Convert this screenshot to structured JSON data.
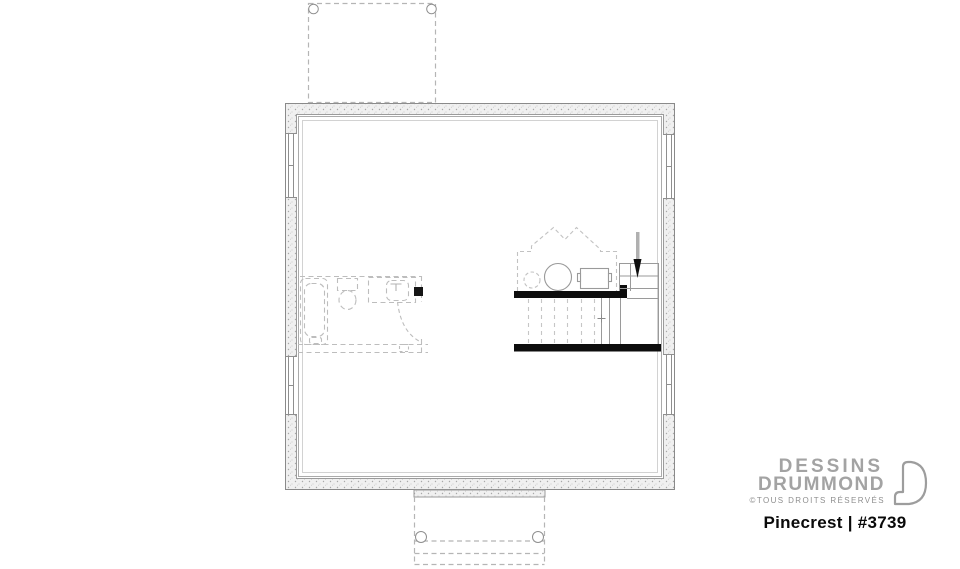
{
  "branding": {
    "name_line1": "DESSINS",
    "name_line2": "DRUMMOND",
    "rights": "©TOUS DROITS RÉSERVÉS",
    "logo_icon": "drummond-d-icon"
  },
  "plan": {
    "title": "Pinecrest | #3739",
    "name": "Pinecrest",
    "number": "#3739"
  },
  "drawing": {
    "type": "basement-floor-plan",
    "colors": {
      "wall_stipple_fill": "#f0f0f0",
      "wall_line": "#8a8a8a",
      "fixture_line": "#9a9a9a",
      "dashed_line": "#bdbdbd",
      "solid_black": "#0d0d0d",
      "logo_gray": "#a3a3a3"
    },
    "elements": [
      "foundation-wall",
      "basement-window",
      "porch-above-outline",
      "rear-porch-outline",
      "porch-post",
      "future-bathroom",
      "bathtub",
      "toilet",
      "vanity-sink",
      "bathroom-door-swing",
      "mechanical-room",
      "water-heater",
      "floor-drain",
      "mechanical-unit",
      "staircase",
      "stair-down-arrow"
    ]
  }
}
